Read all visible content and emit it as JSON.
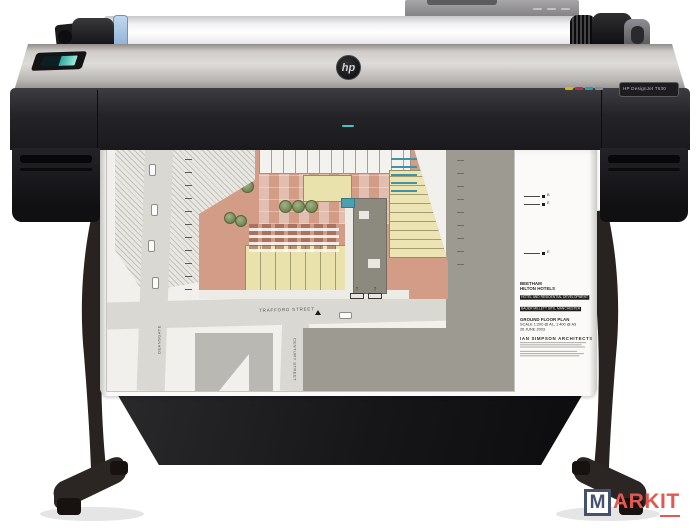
{
  "printer": {
    "brand": "hp",
    "model_badge": "HP DesignJet T630",
    "ink_dash_colors": [
      "#d9b512",
      "#b23058",
      "#2ba0a2",
      "#8d8d91"
    ],
    "accent_teal": "#3ec8bf"
  },
  "plan": {
    "streets": {
      "trafford": "TRAFFORD STREET",
      "century": "CENTURY STREET",
      "deansgate": "DEANSGATE"
    },
    "title_block": {
      "client": "BEETHAM",
      "project": "HILTON HOTELS",
      "subtitle": "HOTEL AND RESIDENTIAL DEVELOPMENT",
      "site": "BAUER MILLETT SITE, MANCHESTER",
      "drawing": "GROUND FLOOR PLAN",
      "scale": "SCALE  1:200 @ A1, 1:400 @ A3",
      "date": "26 JUNE 2003",
      "architect": "IAN SIMPSON ARCHITECTS"
    },
    "markers": [
      "B",
      "E",
      "E"
    ]
  },
  "watermark": {
    "m": "M",
    "ark": "ARK",
    "it": "IT",
    "navy": "#44536b",
    "red": "#e25950"
  }
}
